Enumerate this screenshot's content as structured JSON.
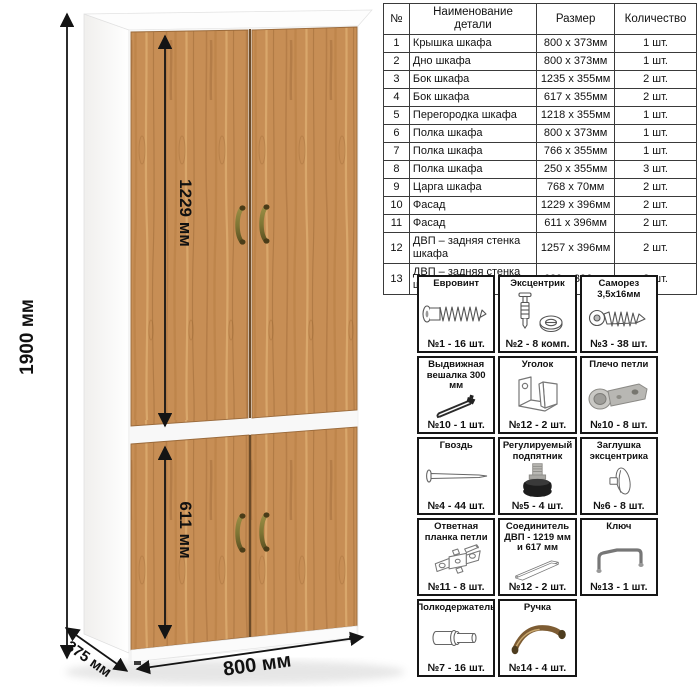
{
  "dimensions": {
    "height": "1900 мм",
    "upper_door": "1229 мм",
    "lower_door": "611 мм",
    "width": "800 мм",
    "depth": "375 мм"
  },
  "parts_table": {
    "headers": [
      "№",
      "Наименование детали",
      "Размер",
      "Количество"
    ],
    "rows": [
      [
        "1",
        "Крышка шкафа",
        "800 x 373мм",
        "1 шт."
      ],
      [
        "2",
        "Дно шкафа",
        "800 x 373мм",
        "1 шт."
      ],
      [
        "3",
        "Бок шкафа",
        "1235 x 355мм",
        "2 шт."
      ],
      [
        "4",
        "Бок шкафа",
        "617 x 355мм",
        "2 шт."
      ],
      [
        "5",
        "Перегородка шкафа",
        "1218 x 355мм",
        "1 шт."
      ],
      [
        "6",
        "Полка шкафа",
        "800 x 373мм",
        "1 шт."
      ],
      [
        "7",
        "Полка шкафа",
        "766 x 355мм",
        "1 шт."
      ],
      [
        "8",
        "Полка шкафа",
        "250 x 355мм",
        "3 шт."
      ],
      [
        "9",
        "Царга шкафа",
        "768 x 70мм",
        "2 шт."
      ],
      [
        "10",
        "Фасад",
        "1229 x 396мм",
        "2 шт."
      ],
      [
        "11",
        "Фасад",
        "611 x 396мм",
        "2 шт."
      ],
      [
        "12",
        "ДВП – задняя стенка шкафа",
        "1257 x 396мм",
        "2 шт."
      ],
      [
        "13",
        "ДВП – задняя стенка шкафа",
        "639 x 396мм",
        "2 шт."
      ]
    ]
  },
  "hardware": {
    "items": [
      {
        "name": "Евровинт",
        "icon": "euro-screw",
        "count": "№1 - 16 шт."
      },
      {
        "name": "Эксцентрик",
        "icon": "cam-lock",
        "count": "№2 - 8 комп."
      },
      {
        "name": "Саморез 3,5х16мм",
        "icon": "self-tapping-screw",
        "count": "№3 - 38 шт."
      },
      {
        "name": "Выдвижная вешалка 300 мм",
        "icon": "pull-out-hanger",
        "count": "№10 - 1 шт."
      },
      {
        "name": "Уголок",
        "icon": "corner-bracket",
        "count": "№12 - 2 шт."
      },
      {
        "name": "Плечо петли",
        "icon": "hinge-arm",
        "count": "№10 - 8 шт."
      },
      {
        "name": "Гвоздь",
        "icon": "nail",
        "count": "№4 - 44 шт."
      },
      {
        "name": "Регулируемый подпятник",
        "icon": "adjustable-foot",
        "count": "№5 - 4 шт."
      },
      {
        "name": "Заглушка эксцентрика",
        "icon": "cam-cap",
        "count": "№6 - 8 шт."
      },
      {
        "name": "Ответная планка петли",
        "icon": "hinge-plate",
        "count": "№11 - 8 шт."
      },
      {
        "name": "Соединитель ДВП - 1219 мм и 617 мм",
        "icon": "hdf-connector",
        "count": "№12 - 2 шт."
      },
      {
        "name": "Ключ",
        "icon": "key",
        "count": "№13 - 1 шт."
      },
      {
        "name": "Полкодержатель",
        "icon": "shelf-pin",
        "count": "№7 - 16 шт."
      },
      {
        "name": "Ручка",
        "icon": "handle",
        "count": "№14 - 4 шт."
      }
    ]
  },
  "colors": {
    "wood": "#c78e55",
    "wood_dark": "#a8713d",
    "carcass_white": "#fdfdfd",
    "handle_bronze": "#7f7635",
    "line_black": "#141414"
  }
}
